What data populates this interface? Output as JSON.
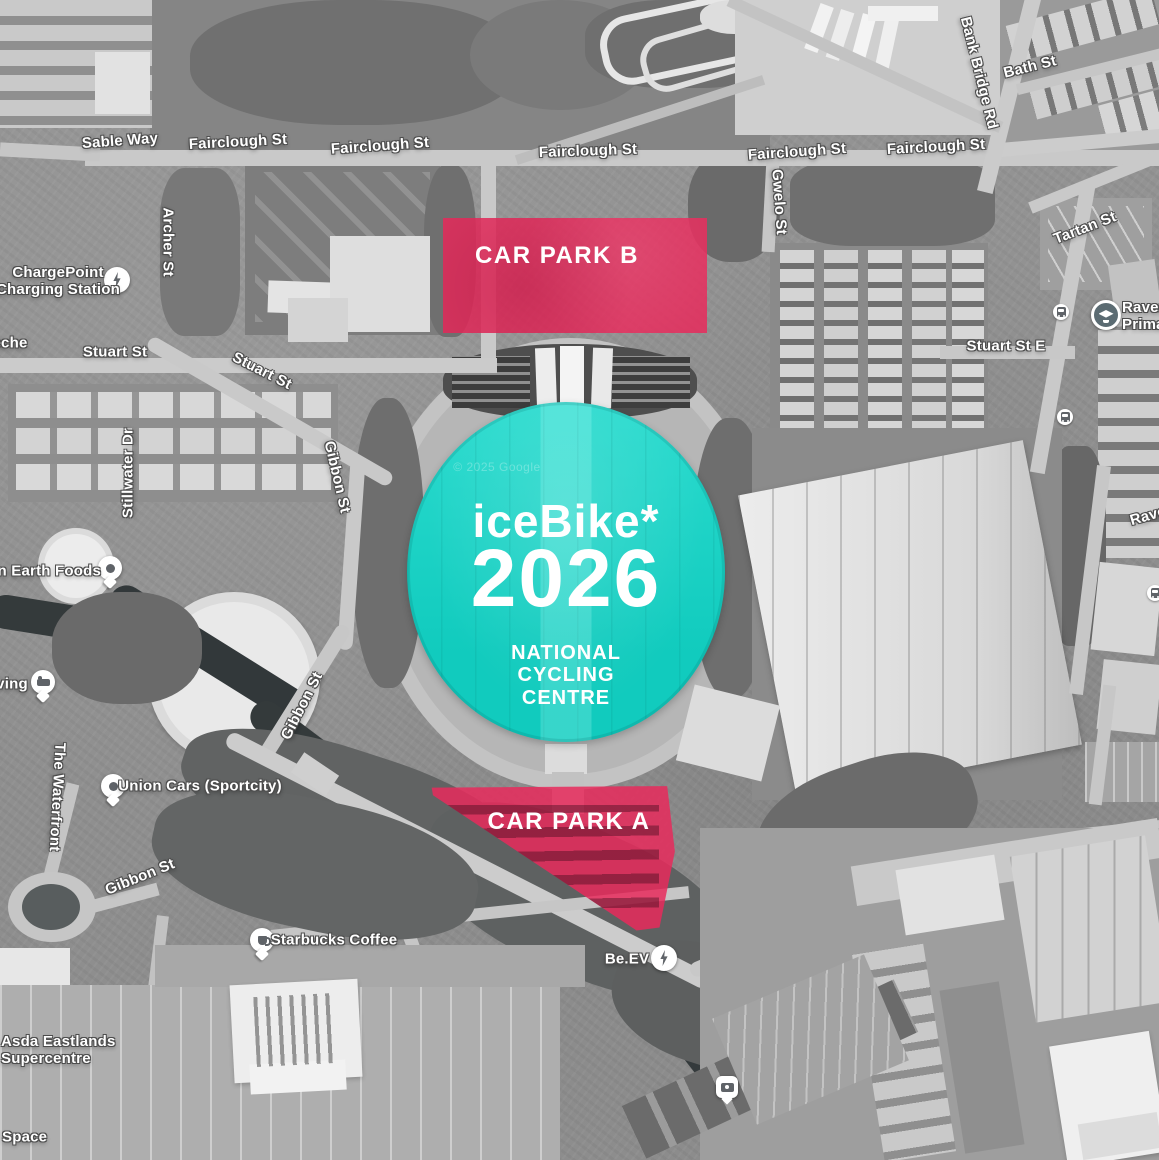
{
  "venue": {
    "title": "iceBike*",
    "year": "2026",
    "subtitle_lines": [
      "NATIONAL",
      "CYCLING",
      "CENTRE"
    ],
    "overlay_color": "#12d7c9"
  },
  "car_parks": [
    {
      "id": "B",
      "label": "CAR PARK B",
      "overlay_color": "#e82a5c"
    },
    {
      "id": "A",
      "label": "CAR PARK A",
      "overlay_color": "#e82a5c"
    }
  ],
  "attribution": "© 2025 Google",
  "street_labels": [
    {
      "text": "Sable Way",
      "x": 120,
      "y": 141,
      "rot": -4
    },
    {
      "text": "Fairclough St",
      "x": 238,
      "y": 142,
      "rot": -3
    },
    {
      "text": "Fairclough St",
      "x": 380,
      "y": 146,
      "rot": -4
    },
    {
      "text": "Fairclough St",
      "x": 588,
      "y": 151,
      "rot": -2
    },
    {
      "text": "Fairclough St",
      "x": 797,
      "y": 152,
      "rot": -4
    },
    {
      "text": "Fairclough St",
      "x": 936,
      "y": 147,
      "rot": -3
    },
    {
      "text": "Archer St",
      "x": 168,
      "y": 242,
      "rot": 90
    },
    {
      "text": "Stuart St",
      "x": 115,
      "y": 352,
      "rot": 0
    },
    {
      "text": "Stuart St",
      "x": 262,
      "y": 371,
      "rot": 27
    },
    {
      "text": "Stuart St E",
      "x": 1006,
      "y": 346,
      "rot": 0
    },
    {
      "text": "Tartan St",
      "x": 1085,
      "y": 228,
      "rot": -21
    },
    {
      "text": "Bank Bridge Rd",
      "x": 979,
      "y": 73,
      "rot": 76
    },
    {
      "text": "Bath St",
      "x": 1030,
      "y": 67,
      "rot": -14
    },
    {
      "text": "Gwelo St",
      "x": 779,
      "y": 202,
      "rot": 86
    },
    {
      "text": "Stillwater Dr",
      "x": 128,
      "y": 473,
      "rot": -90
    },
    {
      "text": "Gibbon St",
      "x": 337,
      "y": 477,
      "rot": 77
    },
    {
      "text": "Gibbon St",
      "x": 302,
      "y": 706,
      "rot": -63
    },
    {
      "text": "Gibbon St",
      "x": 140,
      "y": 877,
      "rot": -22
    },
    {
      "text": "The Waterfront",
      "x": 57,
      "y": 797,
      "rot": 93
    },
    {
      "text": "Rave",
      "x": 1148,
      "y": 516,
      "rot": -16
    }
  ],
  "poi_labels": [
    {
      "lines": [
        "ChargePoint",
        "Charging Station"
      ],
      "x": 58,
      "y": 281,
      "align": "center"
    },
    {
      "lines": [
        "eche"
      ],
      "x": 10,
      "y": 343,
      "align": "center"
    },
    {
      "lines": [
        "en Earth Foods"
      ],
      "x": 45,
      "y": 571,
      "align": "center"
    },
    {
      "lines": [
        "ving"
      ],
      "x": 12,
      "y": 684,
      "align": "center"
    },
    {
      "lines": [
        "Union Cars (Sportcity)"
      ],
      "x": 200,
      "y": 786,
      "align": "center"
    },
    {
      "lines": [
        "Starbucks Coffee"
      ],
      "x": 334,
      "y": 940,
      "align": "center"
    },
    {
      "lines": [
        "Be.EV"
      ],
      "x": 627,
      "y": 959,
      "align": "center"
    },
    {
      "lines": [
        "Raven",
        "Prima"
      ],
      "x": 1122,
      "y": 316,
      "align": "left"
    },
    {
      "lines": [
        "Asda Eastlands",
        "Supercentre"
      ],
      "x": 1,
      "y": 1050,
      "align": "left"
    },
    {
      "lines": [
        "Space"
      ],
      "x": 2,
      "y": 1137,
      "align": "left"
    }
  ],
  "icons": [
    {
      "type": "circle-bolt",
      "name": "ev-charging-icon",
      "x": 117,
      "y": 280
    },
    {
      "type": "pin-dot",
      "name": "store-pin-icon",
      "x": 110,
      "y": 568
    },
    {
      "type": "pin-bed",
      "name": "lodging-pin-icon",
      "x": 43,
      "y": 682
    },
    {
      "type": "pin-dot",
      "name": "car-hire-pin-icon",
      "x": 113,
      "y": 786
    },
    {
      "type": "pin-cup",
      "name": "coffee-pin-icon",
      "x": 262,
      "y": 940
    },
    {
      "type": "circle-bolt",
      "name": "ev-charging-icon",
      "x": 664,
      "y": 958
    },
    {
      "type": "circle-bus",
      "name": "bus-stop-icon",
      "x": 1061,
      "y": 312
    },
    {
      "type": "circle-bus",
      "name": "bus-stop-icon",
      "x": 1065,
      "y": 417
    },
    {
      "type": "circle-bus",
      "name": "bus-stop-icon",
      "x": 1155,
      "y": 593
    },
    {
      "type": "circle-school",
      "name": "school-icon",
      "x": 1106,
      "y": 315
    },
    {
      "type": "square-camera",
      "name": "photo-pin-icon",
      "x": 727,
      "y": 1057
    }
  ]
}
